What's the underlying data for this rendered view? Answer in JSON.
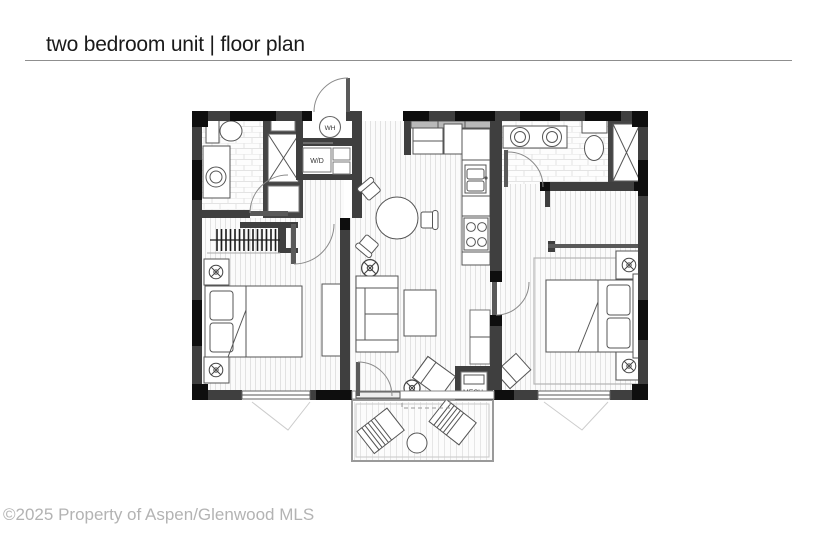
{
  "header": {
    "title": "two bedroom unit | floor plan"
  },
  "footer": {
    "watermark": "©2025 Property of Aspen/Glenwood MLS"
  },
  "plan": {
    "labels": {
      "water_heater": "WH",
      "washer_dryer": "W/D",
      "mechanical": "MECH."
    },
    "colors": {
      "background": "#ffffff",
      "wall": "#3f3f3f",
      "wall_dark": "#0e0e0e",
      "floor_hatch": "#e0e0e0",
      "fixture_stroke": "#555555",
      "title_text": "#1a1a1a",
      "watermark_text": "#b3b3b3"
    }
  }
}
